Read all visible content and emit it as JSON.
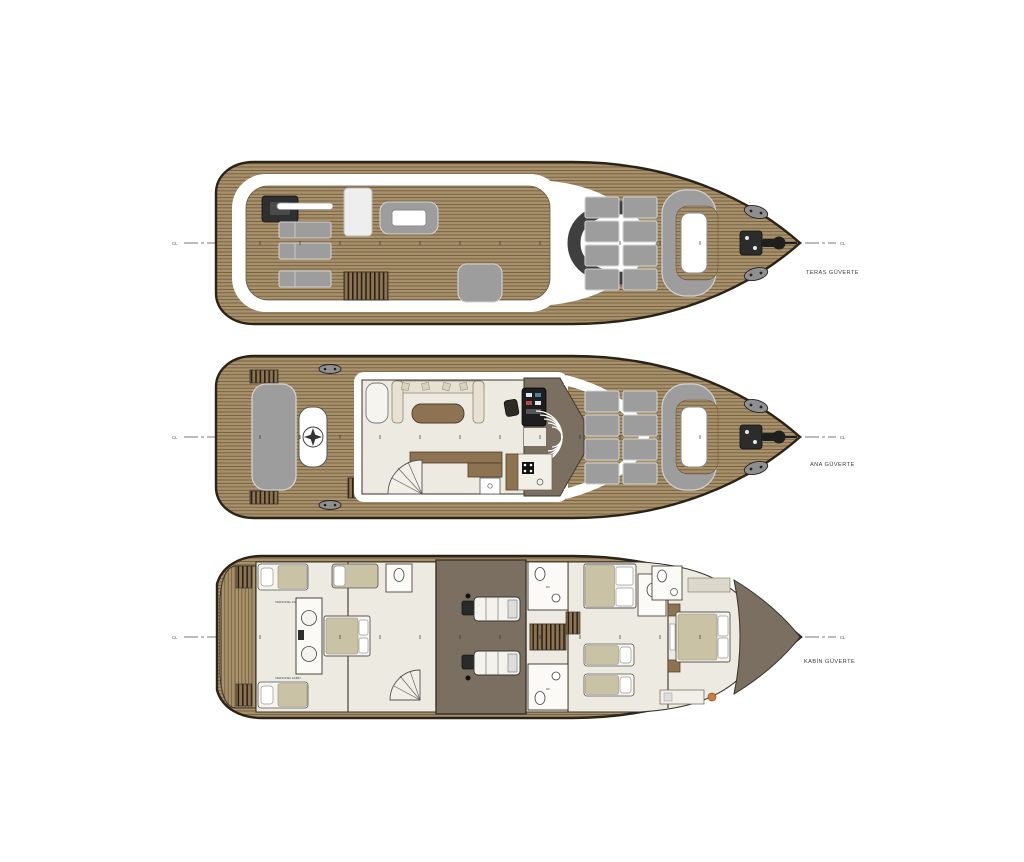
{
  "drawing": {
    "kind": "yacht-deck-plans",
    "background": "#ffffff"
  },
  "colors": {
    "bg": "#ffffff",
    "hull": "#2b2317",
    "teak": "#a8916a",
    "teak-line": "#5a4a30",
    "wood": "#8d7351",
    "pad": "#9d9d9d",
    "pad-edge": "#d2d2d2",
    "interior": "#edeae1",
    "cream": "#e8e1d2",
    "beige": "#c9c2a4",
    "taupe": "#7a6f61",
    "wall": "#3a332a",
    "dark": "#262626",
    "accent-orange": "#c87f3f",
    "cl-line": "#4d4d4d"
  },
  "decks": [
    {
      "id": "teras",
      "label": "TERAS GÜVERTE",
      "cl_left": "CL",
      "cl_right": "CL"
    },
    {
      "id": "ana",
      "label": "ANA GÜVERTE",
      "cl_left": "CL",
      "cl_right": "CL"
    },
    {
      "id": "kabin",
      "label": "KABİN GÜVERTE",
      "cl_left": "CL",
      "cl_right": "CL",
      "rooms": {
        "crew_cabin_top": "PERSONEL KABİN",
        "crew_cabin_bottom": "PERSONEL KABİN",
        "wc_top": "WC",
        "wc_bottom": "WC"
      }
    }
  ]
}
